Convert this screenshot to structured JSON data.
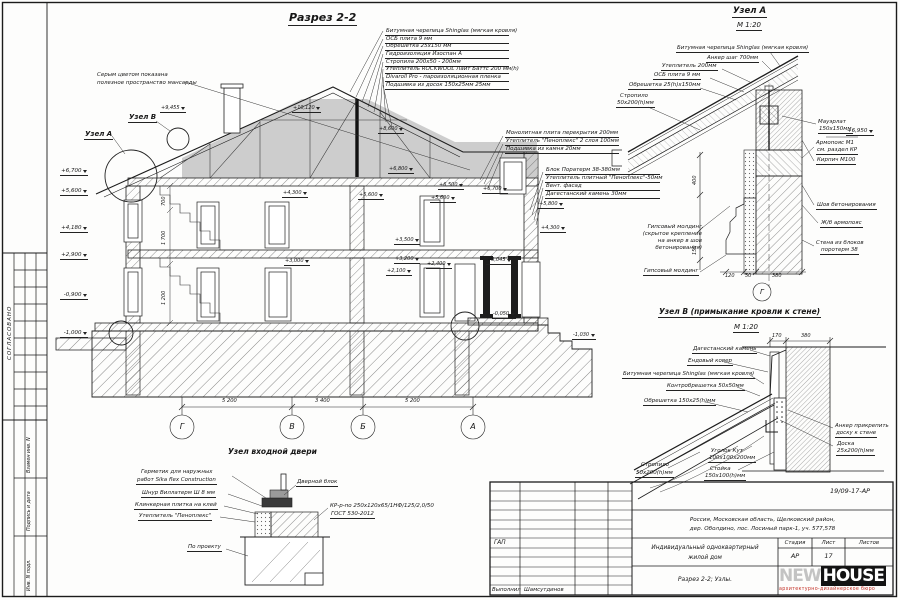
{
  "side": {
    "approved": "СОГЛАСОВАНО",
    "inv1": "Взамен инв. N",
    "inv2": "Подпись и дата",
    "inv3": "Инв. N подл."
  },
  "section": {
    "title": "Разрез 2-2",
    "note1": "Серым цветом показана",
    "note2": "полезное пространство мансарды",
    "calloutA": "Узел А",
    "calloutB": "Узел В",
    "roof_layers": [
      "Битумная черепица Shinglas (мягкая кровля)",
      "ОСБ плита 9 мм",
      "Обрешетка 25х150 мм",
      "Гидроизоляция Изоспан А",
      "Стропила 200х50 - 200мм",
      "Утеплитель ROCKWOOL Лайт Баттс 200 мм(h)",
      "Divaroll Pro - пароизоляционная пленка",
      "Подшивка из досок 150х25мм 25мм"
    ],
    "slab_notes": [
      "Монолитная плита перекрытия 200мм",
      "Утеплитель \"Пеноплекс\" 2 слоя 100мм",
      "Подшивка из камня 20мм"
    ],
    "wall_notes": [
      "Блок Поратерм 38-380мм",
      "Утеплитель плитный \"Пеноплекс\"-50мм",
      "Вент. фасад",
      "Дагестанский камень 30мм"
    ],
    "elev_left": [
      "+6,700",
      "+5,600",
      "+4,180",
      "+2,900",
      "-0,900",
      "-1,000"
    ],
    "marks": {
      "m1": "+9,455",
      "m2": "+10,120",
      "m3": "+8,600",
      "m4": "+6,800",
      "m5": "+6,500",
      "m6": "+5,600",
      "m7": "+5,600",
      "m8": "+4,300",
      "m9": "+3,500",
      "m10": "+3,200",
      "m11": "+2,100",
      "m12": "+2,400",
      "m13": "+3,000",
      "m14": "+6,700",
      "m15": "+5,800",
      "m16": "+4,300",
      "m17": "+3,045",
      "m18": "-0,050",
      "m19": "-1,030"
    },
    "vdims": [
      "700",
      "1 700",
      "1 200"
    ],
    "axes": [
      "Г",
      "В",
      "Б",
      "А"
    ],
    "axis_dims": [
      "5 200",
      "3 400",
      "5 200"
    ]
  },
  "nodeA": {
    "title": "Узел А",
    "scale": "М 1:20",
    "axis": "Г",
    "l1": "Битумная черепица Shinglas (мягкая кровля)",
    "l2": "Анкер шаг 700мм",
    "l3": "Утеплитель 200мм",
    "l4": "ОСБ плита 9 мм",
    "l5": "Обрешетка 25(h)х150мм",
    "l6": "Стропило",
    "l6b": "50х200(h)мм",
    "r1": "Мауэрлат",
    "r1b": "150х150мм",
    "r2": "Армопояс М1",
    "r2b": "см. раздел КР",
    "r3": "Кирпич М100",
    "r4": "Шов бетонирования",
    "r5": "Ж/б армопояс",
    "r6": "Стена из блоков",
    "r6b": "поротерм 38",
    "g1": "Гипсовый молдинг",
    "g1b": "(скрытое крепление",
    "g1c": "на анкер в шов",
    "g1d": "бетонирования)",
    "g2": "Гипсовый молдинг",
    "elev": "+6,950",
    "d1": "120",
    "d2": "50",
    "d3": "380",
    "d4": "400",
    "d5": "150"
  },
  "nodeB": {
    "title": "Узел В (примыкание кровли к  стене)",
    "scale": "М 1:20",
    "l1": "Дагестанский камень",
    "l2": "Ендовый ковер",
    "l3": "Битумная черепица Shinglas (мягкая кровля)",
    "l4": "Контробрешетка 50х50мм",
    "l5": "Обрешетка 150х25(h)мм",
    "l6": "Стропило",
    "l6b": "50х200(h)мм",
    "l7": "Уголок Кут",
    "l7b": "100х100х200мм",
    "l8": "Стойка",
    "l8b": "150х100(h)мм",
    "r1": "Анкер прикрепить",
    "r1b": "доску к стене",
    "r2": "Доска",
    "r2b": "25х200(h)мм",
    "d1": "170",
    "d2": "380"
  },
  "door": {
    "title": "Узел входной двери",
    "l1": "Герметик для наружных",
    "l1b": "работ Sika flex Construction",
    "l2": "Шнур Виллатерм Ш 8 мм",
    "l3": "Клинкерная плитка на клей",
    "l4": "Утеплитель \"Пеноплекс\"",
    "l5": "По проекту",
    "r1": "Дверной блок",
    "r2": "КР-р-по 250х120х65/1НФ/125/2,0/50",
    "r2b": "ГОСТ 530-2012"
  },
  "titleblock": {
    "doc": "19/09-17-АР",
    "addr1": "Россия, Московская область, Щелковский район,",
    "addr2": "дер. Оболдино, пос. Лосиный парк-1, уч. 577,578",
    "gap": "ГАП",
    "object1": "Индивидуальный одноквартирный",
    "object2": "жилой дом",
    "h_stage": "Стадия",
    "h_sheet": "Лист",
    "h_sheets": "Листов",
    "stage": "АР",
    "sheet": "17",
    "sheet_title": "Разрез 2-2; Узлы.",
    "role": "Выполнил",
    "name": "Шамсутдинов",
    "logo1": "NEW",
    "logo2": "HOUSE",
    "logo_sub": "архитектурно-дизайнерское бюро"
  }
}
